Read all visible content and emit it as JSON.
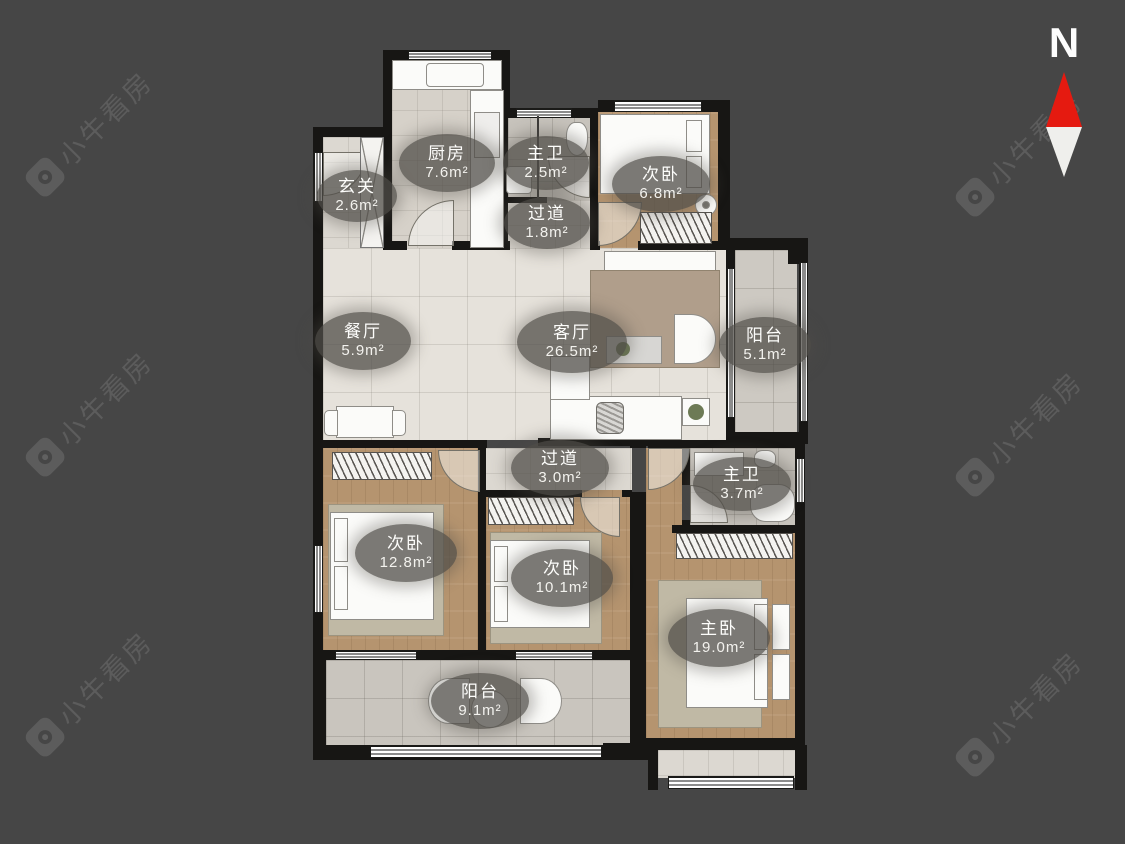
{
  "compass": {
    "label": "N",
    "arrow_up_color": "#e51a10"
  },
  "watermark": {
    "text": "小牛看房"
  },
  "rooms": [
    {
      "id": "entry",
      "name": "玄关",
      "area": "2.6m²"
    },
    {
      "id": "kitchen",
      "name": "厨房",
      "area": "7.6m²"
    },
    {
      "id": "bath-top",
      "name": "主卫",
      "area": "2.5m²"
    },
    {
      "id": "bedroom-top",
      "name": "次卧",
      "area": "6.8m²"
    },
    {
      "id": "corridor-top",
      "name": "过道",
      "area": "1.8m²"
    },
    {
      "id": "dining",
      "name": "餐厅",
      "area": "5.9m²"
    },
    {
      "id": "living",
      "name": "客厅",
      "area": "26.5m²"
    },
    {
      "id": "balcony-right",
      "name": "阳台",
      "area": "5.1m²"
    },
    {
      "id": "corridor-mid",
      "name": "过道",
      "area": "3.0m²"
    },
    {
      "id": "bath-mid",
      "name": "主卫",
      "area": "3.7m²"
    },
    {
      "id": "bedroom-left",
      "name": "次卧",
      "area": "12.8m²"
    },
    {
      "id": "bedroom-mid",
      "name": "次卧",
      "area": "10.1m²"
    },
    {
      "id": "master-bedroom",
      "name": "主卧",
      "area": "19.0m²"
    },
    {
      "id": "balcony-bottom",
      "name": "阳台",
      "area": "9.1m²"
    }
  ]
}
